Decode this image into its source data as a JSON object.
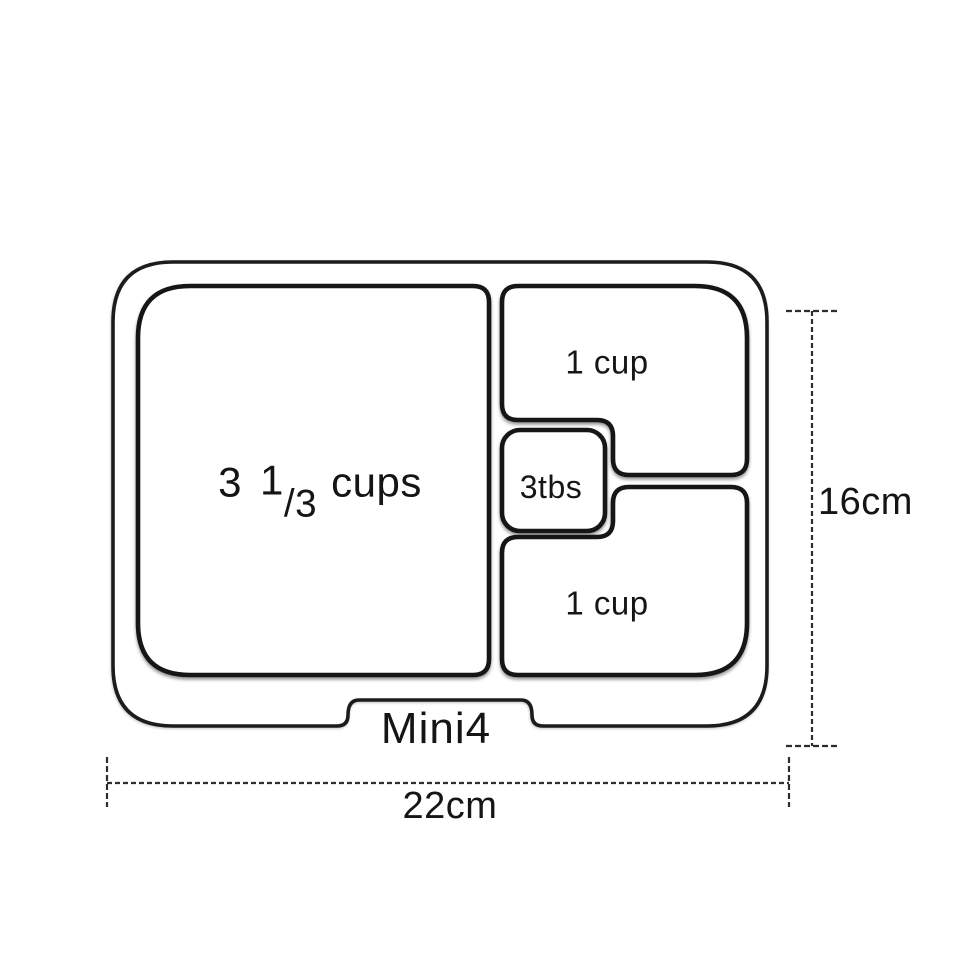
{
  "page": {
    "background": "#ffffff"
  },
  "diagram": {
    "product_name": "Mini4",
    "compartments": {
      "main": {
        "whole": "3",
        "numerator": "1",
        "denominator": "/3",
        "unit": "cups"
      },
      "top_right": "1 cup",
      "middle_small": "3tbs",
      "bottom_right": "1 cup"
    },
    "dimensions": {
      "height": "16cm",
      "width": "22cm"
    },
    "colors": {
      "line": "#1d1d1d",
      "dimension_line": "#2e2e2e",
      "text": "#151515"
    }
  }
}
